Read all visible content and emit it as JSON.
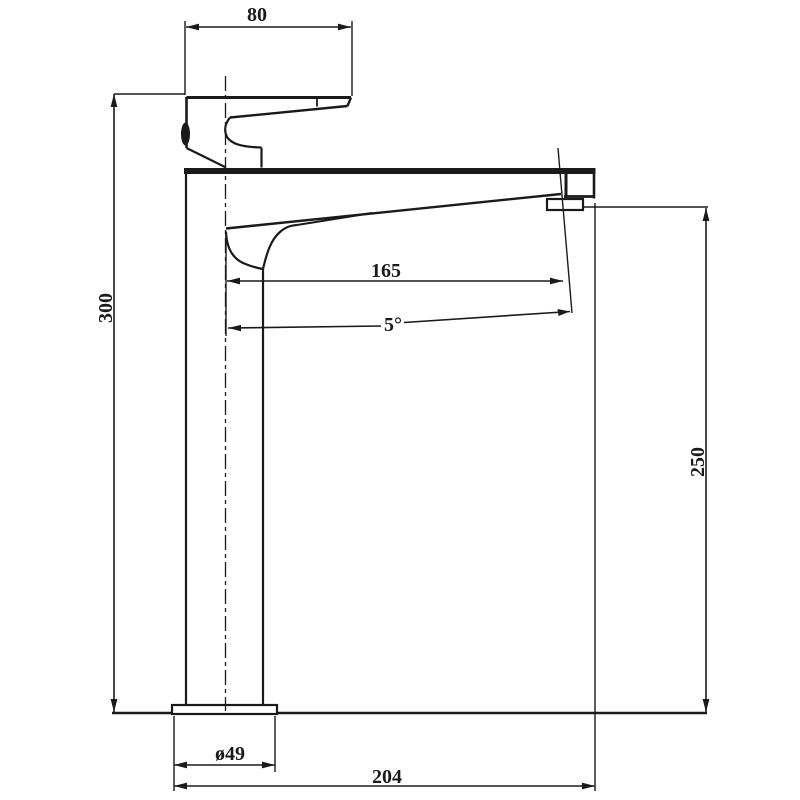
{
  "drawing": {
    "background_color": "#ffffff",
    "line_color": "#1a1a1a",
    "dimensions": {
      "top_width": "80",
      "overall_height": "300",
      "spout_reach": "165",
      "spout_angle": "5°",
      "spout_height": "250",
      "base_diameter": "ø49",
      "overall_depth": "204"
    }
  }
}
